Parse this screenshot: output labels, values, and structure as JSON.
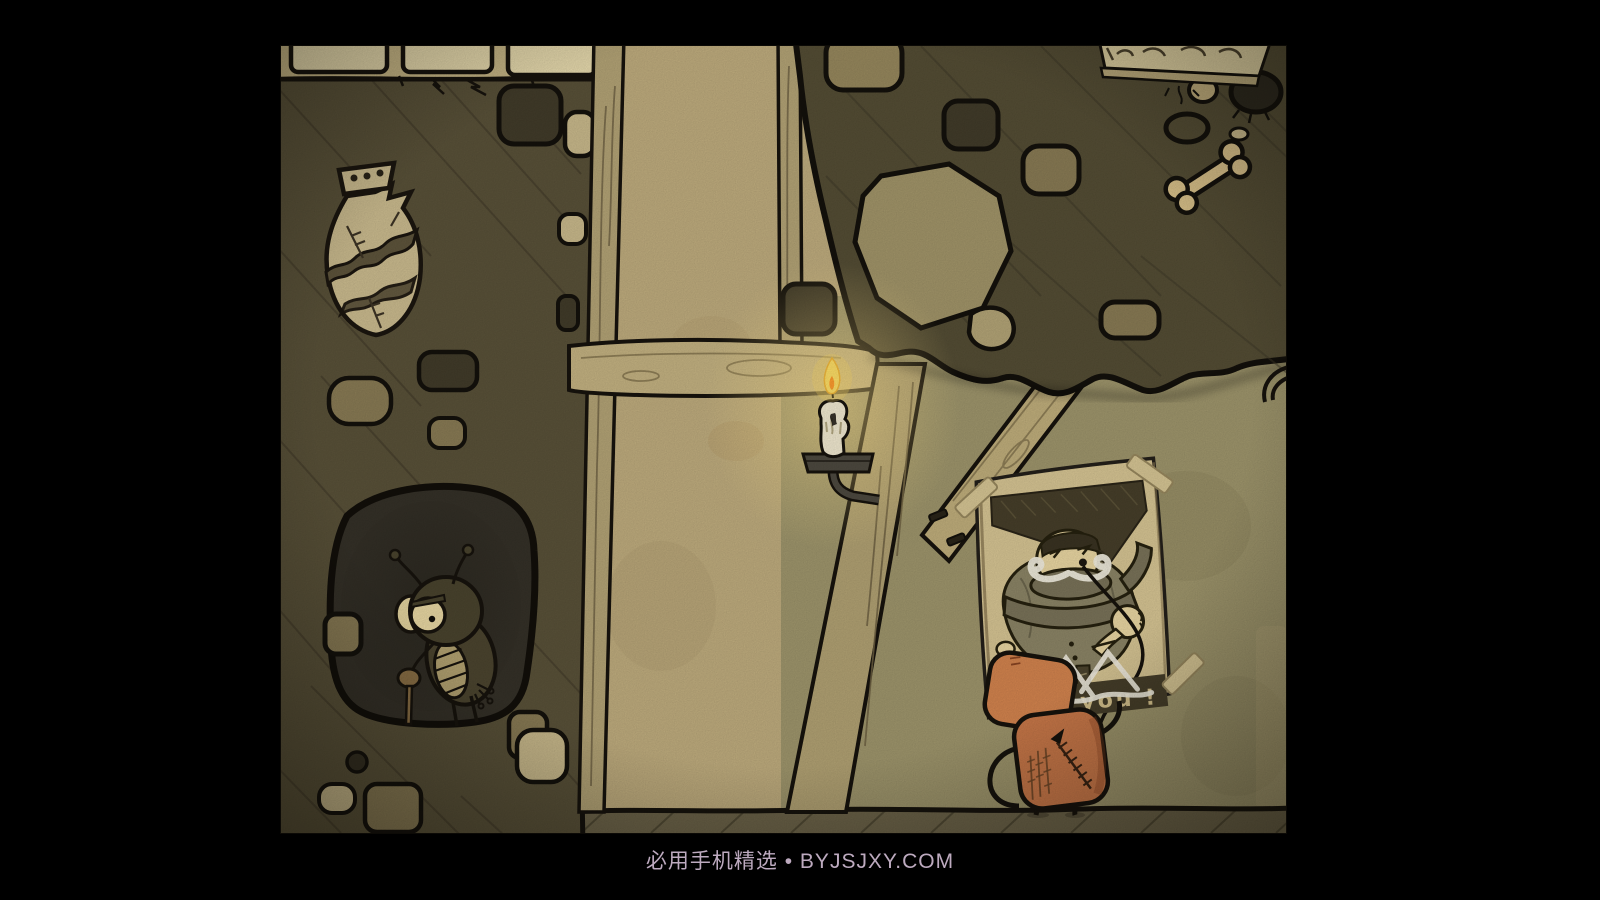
{
  "watermark": {
    "text": "必用手机精选 • BYJSJXY.COM"
  },
  "game": {
    "poster": {
      "caption": "nt you !"
    },
    "palette": {
      "letterbox": "#000000",
      "watermark_text": "#c8b4ca",
      "dirt_wall": "#5a5239",
      "plaster_wall": "#c1ae7f",
      "right_wall": "#a0976d",
      "wood_beam": "#c6b483",
      "floor": "#6e654a",
      "gomo_orange": "#d0804f",
      "poster_paper": "#d9c795",
      "candle_flame": "#ffd854"
    }
  }
}
